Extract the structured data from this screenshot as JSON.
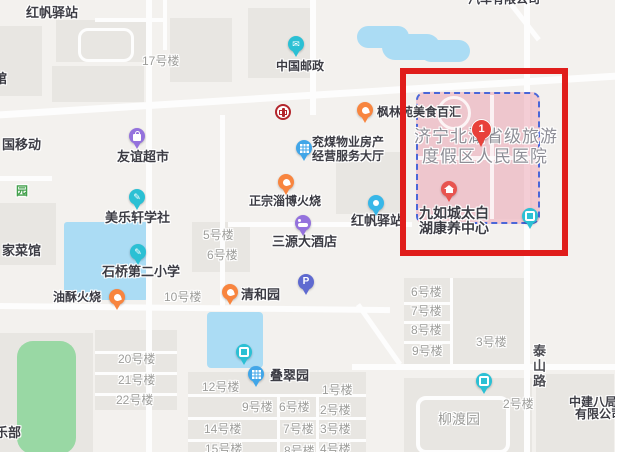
{
  "map": {
    "colors": {
      "background": "#f3f1ee",
      "block": "#e8e6e2",
      "road": "#fdfdfd",
      "water": "#abdcf4",
      "park_green": "#99d8a4",
      "highlight_red": "#e01d1b",
      "parcel_pink": "#f0bac5",
      "parcel_border_blue": "#4a67d8",
      "poi_text": "#3c3c44",
      "building_text": "#9c9c99",
      "area_text": "#8e8e96"
    },
    "highlight_box": {
      "x": 400,
      "y": 68,
      "width": 168,
      "height": 188
    },
    "parcel": {
      "x": 416,
      "y": 92,
      "width": 120,
      "height": 128
    },
    "labels": [
      {
        "t": "红帆驿站",
        "x": 26,
        "y": 6,
        "c": "poi",
        "s": 13
      },
      {
        "t": "17号楼",
        "x": 142,
        "y": 55,
        "c": "bld",
        "s": 12
      },
      {
        "t": "馆",
        "x": -6,
        "y": 72,
        "c": "poi",
        "s": 13
      },
      {
        "t": "中国邮政",
        "x": 276,
        "y": 60,
        "c": "poi",
        "s": 12
      },
      {
        "t": "汽车有限公司",
        "x": 468,
        "y": -7,
        "c": "poi",
        "s": 12
      },
      {
        "t": "枫林苑美食百汇",
        "x": 377,
        "y": 106,
        "c": "poi",
        "s": 12
      },
      {
        "t": "国移动",
        "x": 2,
        "y": 138,
        "c": "poi",
        "s": 13
      },
      {
        "t": "友谊超市",
        "x": 117,
        "y": 150,
        "c": "poi",
        "s": 13
      },
      {
        "t": "兖煤物业房产",
        "x": 312,
        "y": 136,
        "c": "poi",
        "s": 12
      },
      {
        "t": "经营服务大厅",
        "x": 312,
        "y": 150,
        "c": "poi",
        "s": 12
      },
      {
        "t": "济宁北湖省级旅游",
        "x": 414,
        "y": 127,
        "c": "area",
        "s": 17
      },
      {
        "t": "度假区人民医院",
        "x": 422,
        "y": 147,
        "c": "area",
        "s": 17
      },
      {
        "t": "园",
        "x": 16,
        "y": 185,
        "c": "parkt",
        "s": 12
      },
      {
        "t": "正宗淄博火烧",
        "x": 249,
        "y": 195,
        "c": "poi",
        "s": 12
      },
      {
        "t": "美乐轩学社",
        "x": 105,
        "y": 211,
        "c": "poi",
        "s": 13
      },
      {
        "t": "红帆驿站",
        "x": 351,
        "y": 214,
        "c": "poi",
        "s": 13
      },
      {
        "t": "三源大酒店",
        "x": 272,
        "y": 235,
        "c": "poi",
        "s": 13
      },
      {
        "t": "家菜馆",
        "x": 2,
        "y": 244,
        "c": "poi",
        "s": 13
      },
      {
        "t": "九如城太白",
        "x": 419,
        "y": 205,
        "c": "poi",
        "s": 14
      },
      {
        "t": "湖康养中心",
        "x": 419,
        "y": 220,
        "c": "poi",
        "s": 14
      },
      {
        "t": "5号楼",
        "x": 203,
        "y": 229,
        "c": "bld",
        "s": 12
      },
      {
        "t": "6号楼",
        "x": 207,
        "y": 249,
        "c": "bld",
        "s": 12
      },
      {
        "t": "石桥第二小学",
        "x": 102,
        "y": 265,
        "c": "poi",
        "s": 13
      },
      {
        "t": "油酥火烧",
        "x": 53,
        "y": 291,
        "c": "poi",
        "s": 12
      },
      {
        "t": "10号楼",
        "x": 164,
        "y": 291,
        "c": "bld",
        "s": 12
      },
      {
        "t": "清和园",
        "x": 241,
        "y": 288,
        "c": "poi",
        "s": 13
      },
      {
        "t": "6号楼",
        "x": 411,
        "y": 286,
        "c": "bld",
        "s": 12
      },
      {
        "t": "7号楼",
        "x": 411,
        "y": 305,
        "c": "bld",
        "s": 12
      },
      {
        "t": "8号楼",
        "x": 411,
        "y": 324,
        "c": "bld",
        "s": 12
      },
      {
        "t": "9号楼",
        "x": 412,
        "y": 345,
        "c": "bld",
        "s": 12
      },
      {
        "t": "3号楼",
        "x": 476,
        "y": 336,
        "c": "bld",
        "s": 12
      },
      {
        "t": "泰山路",
        "x": 530,
        "y": 344,
        "c": "vroad",
        "s": 13
      },
      {
        "t": "20号楼",
        "x": 118,
        "y": 353,
        "c": "bld",
        "s": 12
      },
      {
        "t": "21号楼",
        "x": 118,
        "y": 374,
        "c": "bld",
        "s": 12
      },
      {
        "t": "22号楼",
        "x": 116,
        "y": 394,
        "c": "bld",
        "s": 12
      },
      {
        "t": "叠翠园",
        "x": 270,
        "y": 369,
        "c": "poi",
        "s": 13
      },
      {
        "t": "12号楼",
        "x": 202,
        "y": 381,
        "c": "bld",
        "s": 12
      },
      {
        "t": "1号楼",
        "x": 322,
        "y": 384,
        "c": "bld",
        "s": 12
      },
      {
        "t": "9号楼",
        "x": 242,
        "y": 401,
        "c": "bld",
        "s": 12
      },
      {
        "t": "6号楼",
        "x": 279,
        "y": 401,
        "c": "bld",
        "s": 12
      },
      {
        "t": "2号楼",
        "x": 320,
        "y": 404,
        "c": "bld",
        "s": 12
      },
      {
        "t": "14号楼",
        "x": 204,
        "y": 423,
        "c": "bld",
        "s": 12
      },
      {
        "t": "7号楼",
        "x": 283,
        "y": 423,
        "c": "bld",
        "s": 12
      },
      {
        "t": "3号楼",
        "x": 320,
        "y": 423,
        "c": "bld",
        "s": 12
      },
      {
        "t": "15号楼",
        "x": 205,
        "y": 443,
        "c": "bld",
        "s": 12
      },
      {
        "t": "8号楼",
        "x": 284,
        "y": 445,
        "c": "bld",
        "s": 12
      },
      {
        "t": "4号楼",
        "x": 320,
        "y": 443,
        "c": "bld",
        "s": 12
      },
      {
        "t": "柳渡园",
        "x": 438,
        "y": 411,
        "c": "bld",
        "s": 14
      },
      {
        "t": "2号楼",
        "x": 503,
        "y": 398,
        "c": "bld",
        "s": 12
      },
      {
        "t": "中建八局",
        "x": 569,
        "y": 396,
        "c": "poi",
        "s": 12
      },
      {
        "t": "有限公司",
        "x": 575,
        "y": 408,
        "c": "poi",
        "s": 12
      },
      {
        "t": "乐部",
        "x": -5,
        "y": 426,
        "c": "poi",
        "s": 13
      }
    ],
    "pins": [
      {
        "name": "post-office-pin",
        "x": 296,
        "y": 44,
        "color": "#2bc0d4",
        "glyph": "env",
        "text": "✉"
      },
      {
        "name": "bank-of-china-pin",
        "x": 283,
        "y": 112,
        "color": "#b3262c",
        "glyph": "boc"
      },
      {
        "name": "supermarket-pin",
        "x": 137,
        "y": 136,
        "color": "#9472dd",
        "glyph": "bag"
      },
      {
        "name": "food-plaza-pin",
        "x": 365,
        "y": 110,
        "color": "#f8853f",
        "glyph": "food"
      },
      {
        "name": "property-office-pin",
        "x": 304,
        "y": 148,
        "color": "#41a6e8",
        "glyph": "grid"
      },
      {
        "name": "bbq-restaurant-pin",
        "x": 286,
        "y": 182,
        "color": "#f8853f",
        "glyph": "food"
      },
      {
        "name": "study-club-pin",
        "x": 137,
        "y": 197,
        "color": "#2bc0d4",
        "glyph": "pencil",
        "text": "✎"
      },
      {
        "name": "station-pin",
        "x": 376,
        "y": 203,
        "color": "#38b7e8",
        "glyph": "dot"
      },
      {
        "name": "hotel-pin",
        "x": 303,
        "y": 223,
        "color": "#9472dd",
        "glyph": "bed"
      },
      {
        "name": "school-pin",
        "x": 138,
        "y": 252,
        "color": "#2bc0d4",
        "glyph": "pencil",
        "text": "✎"
      },
      {
        "name": "snack-restaurant-pin",
        "x": 117,
        "y": 297,
        "color": "#f8853f",
        "glyph": "food"
      },
      {
        "name": "restaurant-pin",
        "x": 230,
        "y": 292,
        "color": "#f8853f",
        "glyph": "food"
      },
      {
        "name": "parking-pin",
        "x": 306,
        "y": 282,
        "color": "#5f6ad0",
        "glyph": "P",
        "text": "P"
      },
      {
        "name": "hospital-marker-pin",
        "x": 481,
        "y": 129,
        "color": "#e8413a",
        "glyph": "one",
        "text": "1",
        "big": true
      },
      {
        "name": "eldercare-pin",
        "x": 449,
        "y": 189,
        "color": "#e85450",
        "glyph": "house"
      },
      {
        "name": "gate-pin-1",
        "x": 530,
        "y": 216,
        "color": "#2bc0d4",
        "glyph": "sq"
      },
      {
        "name": "gate-pin-2",
        "x": 244,
        "y": 352,
        "color": "#2bc0d4",
        "glyph": "sq"
      },
      {
        "name": "residential-pin",
        "x": 256,
        "y": 374,
        "color": "#41a6e8",
        "glyph": "grid"
      },
      {
        "name": "gate-pin-3",
        "x": 484,
        "y": 381,
        "color": "#2bc0d4",
        "glyph": "sq"
      }
    ]
  }
}
